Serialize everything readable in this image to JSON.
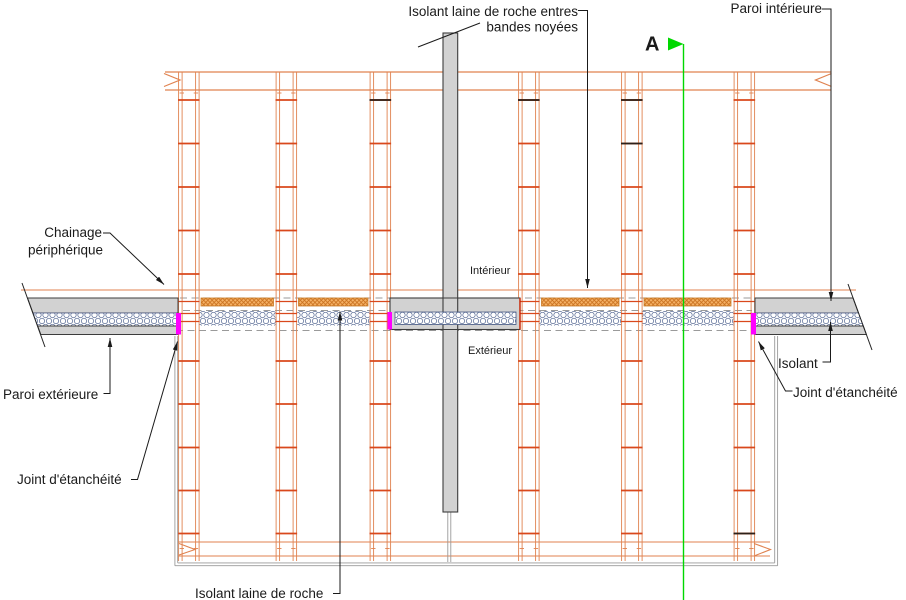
{
  "drawing": {
    "title": "Coupe verticale - mur à prémurs avec plancher (détail d'étanchéité)",
    "labels": {
      "insulation_top_line1": "Isolant laine de roche entres",
      "insulation_top_line2": "bandes noyées",
      "paroi_interieure": "Paroi intérieure",
      "section_marker": "A",
      "chainage_line1": "Chainage",
      "chainage_line2": "périphérique",
      "interieur": "Intérieur",
      "exterieur": "Extérieur",
      "paroi_exterieure": "Paroi extérieure",
      "joint_etancheite_left": "Joint d'étanchéité",
      "isolant": "Isolant",
      "joint_etancheite_right": "Joint d'étanchéité",
      "insulation_bottom": "Isolant laine de roche"
    },
    "colors": {
      "section_green": "#00d800",
      "rebar_orange": "#e0824f",
      "rung_red": "#d9481c",
      "hatch_orange": "#f0a85c",
      "joint_magenta": "#ff00ff",
      "concrete_gray": "#d2d2d2",
      "outline_dark": "#3c3c3c",
      "leader_black": "#1a1a1a"
    }
  }
}
